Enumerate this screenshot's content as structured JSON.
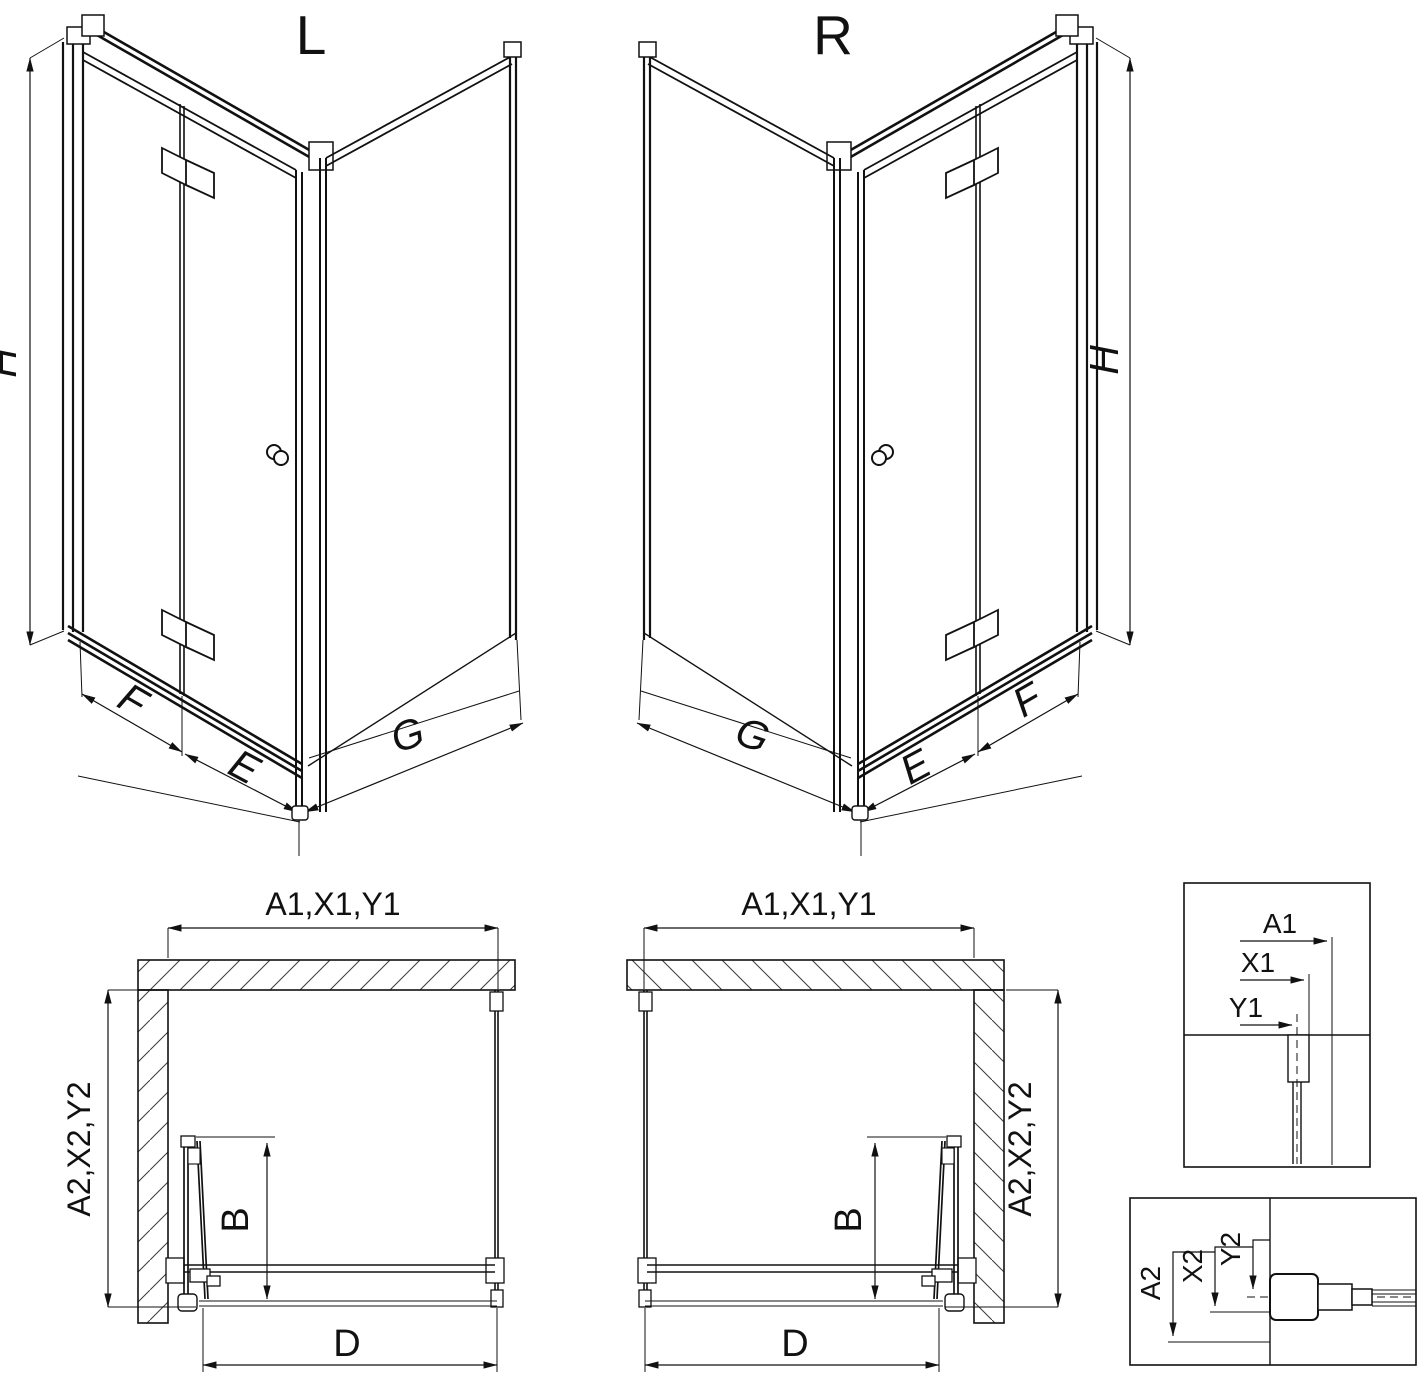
{
  "colors": {
    "line": "#111111",
    "background": "#ffffff"
  },
  "iso_views": [
    {
      "title": "L",
      "height": "H",
      "door_panel": "F",
      "inner_panel": "E",
      "side_panel": "G"
    },
    {
      "title": "R",
      "height": "H",
      "door_panel": "F",
      "inner_panel": "E",
      "side_panel": "G"
    }
  ],
  "plan_views": [
    {
      "width_dim": "A1,X1,Y1",
      "depth_dim": "A2,X2,Y2",
      "fold_dim": "B",
      "entry_dim": "D"
    },
    {
      "width_dim": "A1,X1,Y1",
      "depth_dim": "A2,X2,Y2",
      "fold_dim": "B",
      "entry_dim": "D"
    }
  ],
  "detail_views": [
    {
      "dims": [
        "A1",
        "X1",
        "Y1"
      ]
    },
    {
      "dims": [
        "A2",
        "X2",
        "Y2"
      ]
    }
  ]
}
